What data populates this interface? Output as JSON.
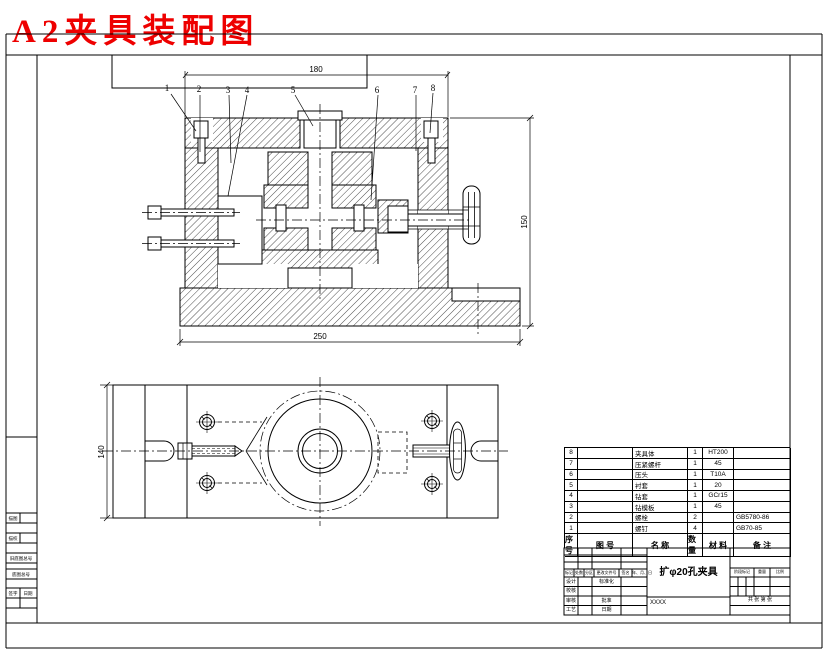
{
  "title": {
    "text": "A2夹具装配图",
    "color": "#ee0000",
    "ink": "#000000"
  },
  "views": {
    "front": {
      "dims": {
        "top": "180",
        "right": "150",
        "bottom": "250"
      },
      "balloons": [
        "1",
        "2",
        "3",
        "4",
        "5",
        "6",
        "7",
        "8"
      ]
    },
    "top": {
      "dims": {
        "left": "140"
      }
    }
  },
  "parts_table": {
    "headers": [
      "序号",
      "图 号",
      "名 称",
      "数量",
      "材 料",
      "备 注"
    ],
    "rows": [
      {
        "seq": "8",
        "code": "",
        "name": "夹具体",
        "qty": "1",
        "material": "HT200",
        "remark": ""
      },
      {
        "seq": "7",
        "code": "",
        "name": "压紧螺杆",
        "qty": "1",
        "material": "45",
        "remark": ""
      },
      {
        "seq": "6",
        "code": "",
        "name": "压头",
        "qty": "1",
        "material": "T10A",
        "remark": ""
      },
      {
        "seq": "5",
        "code": "",
        "name": "衬套",
        "qty": "1",
        "material": "20",
        "remark": ""
      },
      {
        "seq": "4",
        "code": "",
        "name": "钻套",
        "qty": "1",
        "material": "GCr15",
        "remark": ""
      },
      {
        "seq": "3",
        "code": "",
        "name": "钻模板",
        "qty": "1",
        "material": "45",
        "remark": ""
      },
      {
        "seq": "2",
        "code": "",
        "name": "螺栓",
        "qty": "2",
        "material": "",
        "remark": "GB5780-86"
      },
      {
        "seq": "1",
        "code": "",
        "name": "螺钉",
        "qty": "4",
        "material": "",
        "remark": "GB70-85"
      }
    ]
  },
  "title_block": {
    "drawing_name": "扩φ20孔夹具",
    "org": "XXXX",
    "rev_row": [
      "标记",
      "处数",
      "分区",
      "更改文件号",
      "签名",
      "年、月、日"
    ],
    "sign_rows": [
      {
        "c0": "设计",
        "c2": "标准化"
      },
      {
        "c0": "校核",
        "c2": ""
      },
      {
        "c0": "审核",
        "c2": "批准"
      },
      {
        "c0": "工艺",
        "c2": "日期"
      }
    ],
    "right": {
      "headers": [
        "阶段标记",
        "重量",
        "比例"
      ],
      "sheet": "共 张 第 张"
    }
  },
  "margin_block": {
    "labels": [
      "描图",
      "描校",
      "旧底图总号",
      "底图总号",
      "签字",
      "日期"
    ]
  }
}
